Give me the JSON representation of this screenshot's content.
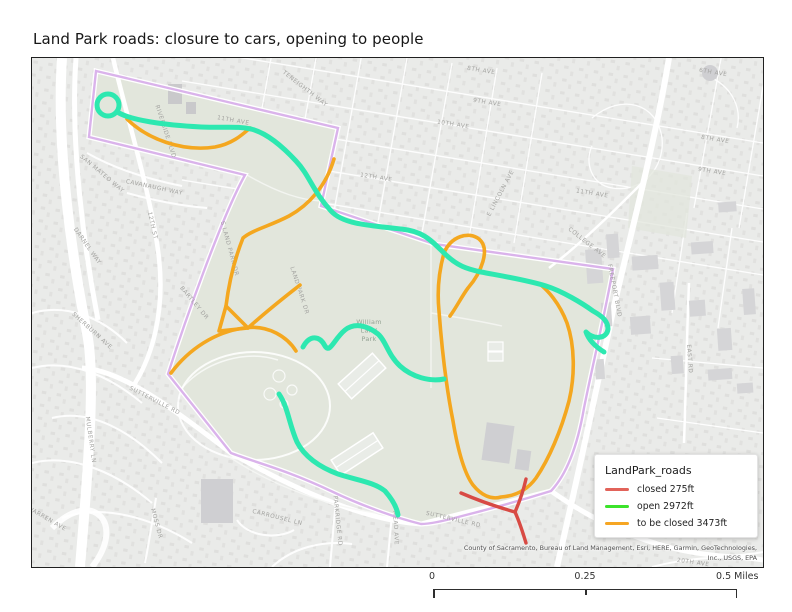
{
  "title": "Land Park roads: closure to cars, opening to people",
  "legend": {
    "title": "LandPark_roads",
    "items": [
      {
        "label": "closed 275ft",
        "color": "#e2635a"
      },
      {
        "label": "open 2972ft",
        "color": "#3ce32b"
      },
      {
        "label": "to be closed 3473ft",
        "color": "#f6a623"
      }
    ]
  },
  "scale_bar": {
    "labels": [
      "0",
      "0.25",
      "0.5 Miles"
    ]
  },
  "attribution": "County of Sacramento, Bureau of Land Management, Esri, HERE, Garmin, GeoTechnologies, Inc., USGS, EPA",
  "map": {
    "park_label": "William Land Park",
    "colors": {
      "open": "#2de8b0",
      "to_be_closed": "#f4a71f",
      "closed": "#d84a44",
      "boundary": "#d6abe9",
      "park_fill": "#e2e6dc",
      "basemap": "#eaebe9",
      "road": "#ffffff",
      "label": "#a3a3a0",
      "park_label": "#94a294",
      "building": "#d5d5d7"
    },
    "street_labels": [
      {
        "text": "8TH AVE",
        "x": 449,
        "y": 14,
        "rotate": 9
      },
      {
        "text": "6TH AVE",
        "x": 681,
        "y": 16,
        "rotate": 9
      },
      {
        "text": "8TH AVE",
        "x": 683,
        "y": 83,
        "rotate": 9
      },
      {
        "text": "9TH AVE",
        "x": 680,
        "y": 115,
        "rotate": 9
      },
      {
        "text": "9TH AVE",
        "x": 455,
        "y": 46,
        "rotate": 9
      },
      {
        "text": "10TH AVE",
        "x": 421,
        "y": 68,
        "rotate": 9
      },
      {
        "text": "11TH AVE",
        "x": 560,
        "y": 137,
        "rotate": 9
      },
      {
        "text": "11TH AVE",
        "x": 201,
        "y": 64,
        "rotate": 10
      },
      {
        "text": "12TH AVE",
        "x": 344,
        "y": 121,
        "rotate": 9
      },
      {
        "text": "E LINCOLN AVE",
        "x": 470,
        "y": 136,
        "rotate": -62
      },
      {
        "text": "TENEIGHTH WAY",
        "x": 272,
        "y": 32,
        "rotate": 38
      },
      {
        "text": "COLLEGE AVE",
        "x": 554,
        "y": 186,
        "rotate": 38
      },
      {
        "text": "FREEPORT BLVD",
        "x": 581,
        "y": 233,
        "rotate": 79
      },
      {
        "text": "EAST RD",
        "x": 656,
        "y": 301,
        "rotate": 86
      },
      {
        "text": "RIVERSIDE BLVD",
        "x": 132,
        "y": 74,
        "rotate": 72
      },
      {
        "text": "SAN MATEO WAY",
        "x": 69,
        "y": 117,
        "rotate": 40
      },
      {
        "text": "CAVANAUGH WAY",
        "x": 122,
        "y": 131,
        "rotate": 12
      },
      {
        "text": "12TH ST",
        "x": 119,
        "y": 168,
        "rotate": 77
      },
      {
        "text": "DARNEL WAY",
        "x": 54,
        "y": 189,
        "rotate": 55
      },
      {
        "text": "SHERBURN AVE",
        "x": 59,
        "y": 274,
        "rotate": 42
      },
      {
        "text": "BARTLEY DR",
        "x": 161,
        "y": 246,
        "rotate": 50
      },
      {
        "text": "S LAND PARK DR",
        "x": 196,
        "y": 191,
        "rotate": 75
      },
      {
        "text": "LAND PARK DR",
        "x": 266,
        "y": 233,
        "rotate": 72
      },
      {
        "text": "SUTTERVILLE RD",
        "x": 122,
        "y": 344,
        "rotate": 27
      },
      {
        "text": "SUTTERVILLE RD",
        "x": 421,
        "y": 463,
        "rotate": 13
      },
      {
        "text": "MULBERRY LN",
        "x": 57,
        "y": 382,
        "rotate": 82
      },
      {
        "text": "MOSS DR",
        "x": 123,
        "y": 466,
        "rotate": 75
      },
      {
        "text": "WARREN AVE",
        "x": 14,
        "y": 462,
        "rotate": 30
      },
      {
        "text": "CARROUSEL LN",
        "x": 245,
        "y": 461,
        "rotate": 14
      },
      {
        "text": "PARKRIDGE RD",
        "x": 304,
        "y": 463,
        "rotate": 84
      },
      {
        "text": "MEAD AVE",
        "x": 362,
        "y": 470,
        "rotate": 87
      },
      {
        "text": "20TH AVE",
        "x": 661,
        "y": 506,
        "rotate": 8
      }
    ]
  }
}
